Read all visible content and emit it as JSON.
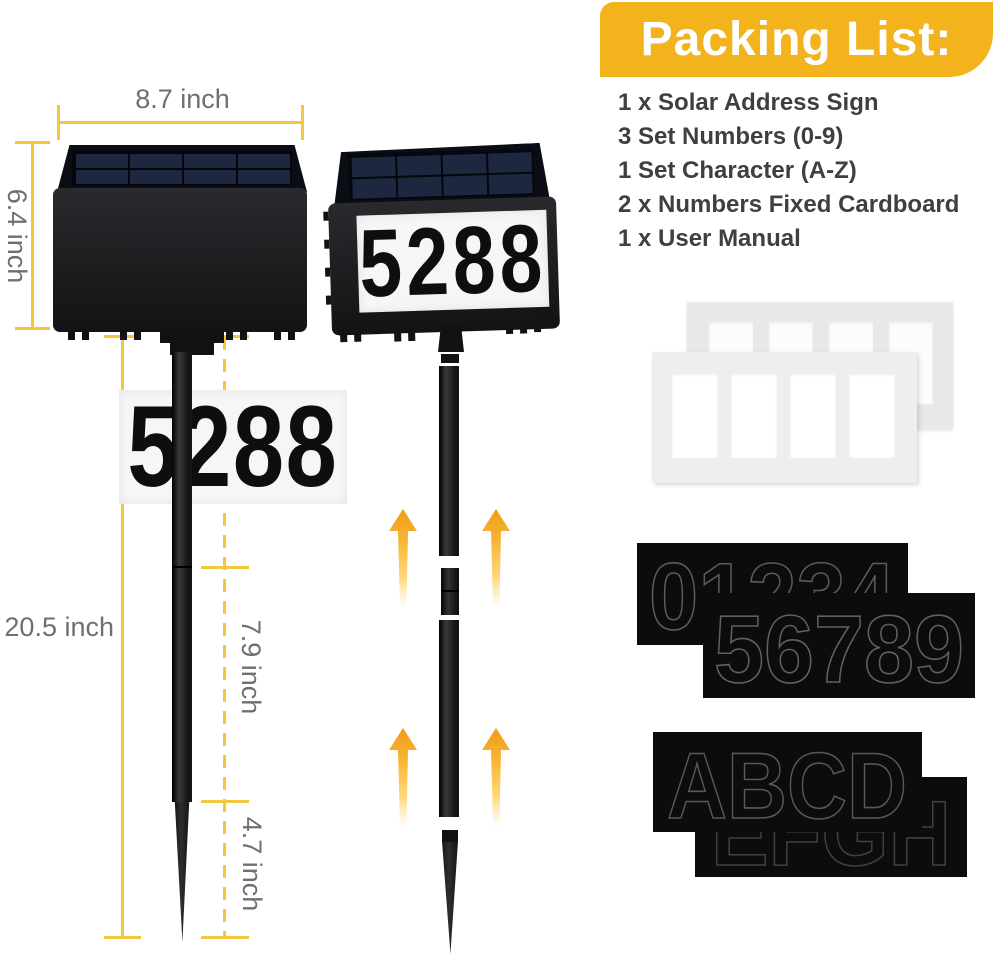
{
  "banner": {
    "label": "Packing List:"
  },
  "packing_list": {
    "items": [
      "1 x Solar Address Sign",
      "3 Set Numbers (0-9)",
      "1 Set Character (A-Z)",
      "2 x Numbers Fixed Cardboard",
      "1 x User Manual"
    ]
  },
  "sign": {
    "address_number": "5288"
  },
  "dimensions": {
    "sign_width": "8.7 inch",
    "sign_height": "6.4 inch",
    "stake_total": "20.5 inch",
    "stake_upper": "7.9 inch",
    "stake_lower": "7.9 inch",
    "stake_spike": "4.7 inch"
  },
  "stencils": {
    "numbers_sheet_back": "01234",
    "numbers_sheet_front": "56789",
    "letters_sheet_front": "ABCD",
    "letters_sheet_back": "EFGH"
  },
  "colors": {
    "banner_yellow": "#F2B31C",
    "dimension_gold": "#F3C63F",
    "arrow_orange": "#F6A91F",
    "list_text": "#3F3F3F"
  }
}
